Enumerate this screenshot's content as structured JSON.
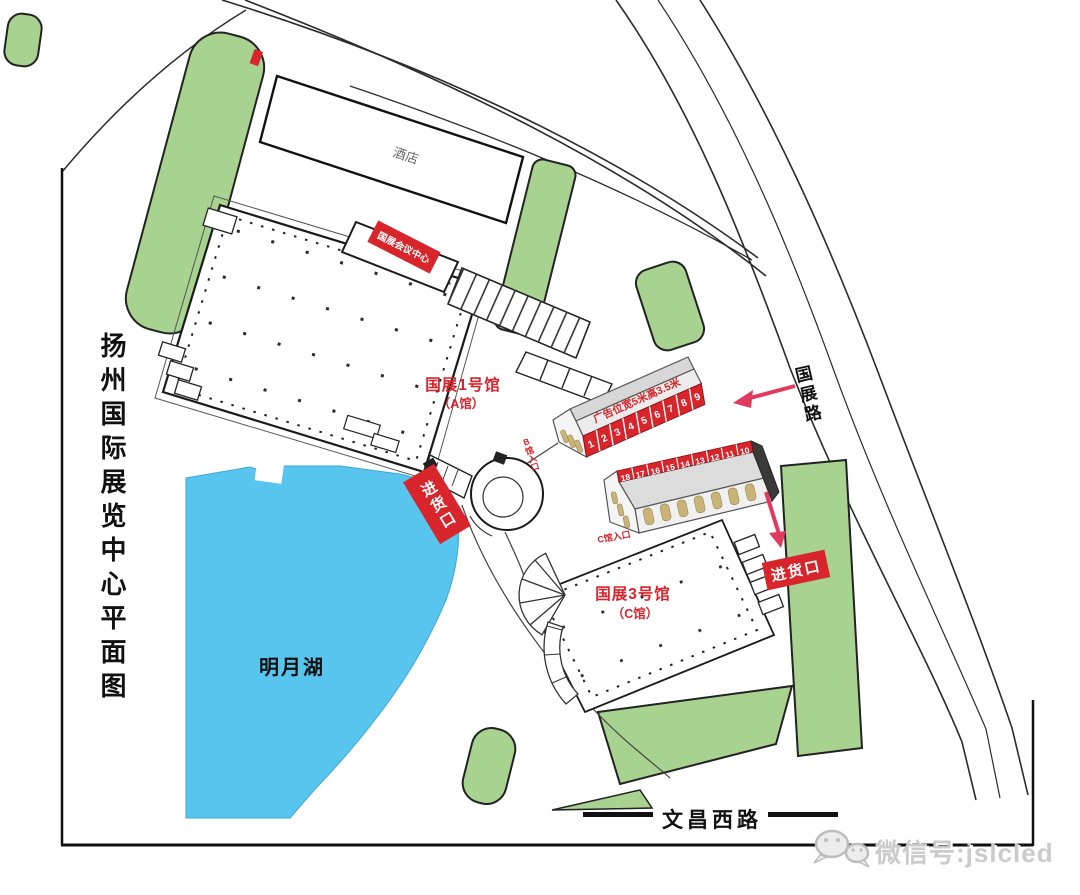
{
  "title": {
    "text": "扬州国际展览中心平面图"
  },
  "hotel": {
    "label": "酒店"
  },
  "lake": {
    "label": "明月湖"
  },
  "roads": {
    "guozhan": "国展路",
    "wenchang_west": "文昌西路"
  },
  "halls": {
    "hall1": {
      "name": "国展1号馆",
      "annex": "（A馆）"
    },
    "hall3": {
      "name": "国展3号馆",
      "annex": "（C馆）"
    },
    "conference": {
      "label": "国展会议中心"
    },
    "temp_b": {
      "roof_label": "广告位宽5米高3.5米",
      "panels": [
        "1",
        "2",
        "3",
        "4",
        "5",
        "6",
        "7",
        "8",
        "9"
      ]
    },
    "temp_c": {
      "panels": [
        "18",
        "17",
        "16",
        "15",
        "14",
        "13",
        "12",
        "11",
        "10"
      ]
    }
  },
  "entrances": {
    "b_entrance": "B馆入口",
    "c_entrance": "C馆入口",
    "loading_1": "进货口",
    "loading_2": "进货口"
  },
  "watermark": {
    "label": "微信号:jslcled"
  },
  "colors": {
    "accent_red": "#d8242b",
    "arrow_red": "#e23a5f",
    "green": "#a8d28f",
    "lake_blue": "#58c5ee"
  }
}
